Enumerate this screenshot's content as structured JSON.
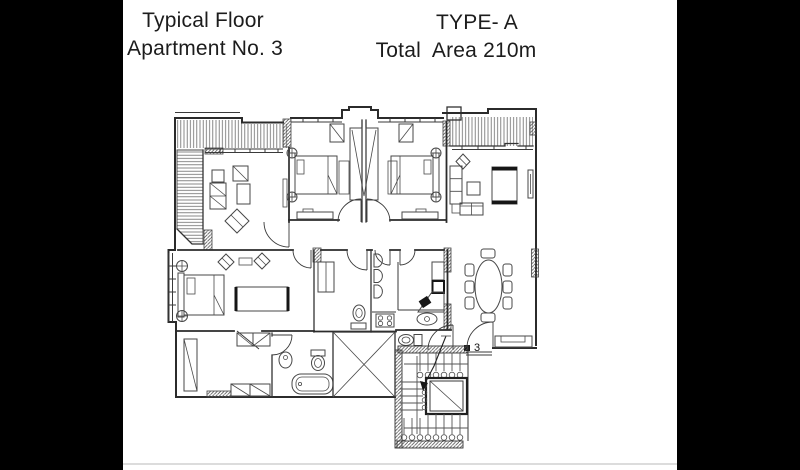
{
  "header": {
    "left_line1": "Typical Floor",
    "left_line2": "Apartment No. 3",
    "right_line1": "TYPE- A",
    "right_line2": "Total  Area 210m"
  },
  "plan": {
    "entrance_label": "3",
    "drawing_description": "Apartment floor plan: two balconies, sitting room, two bedrooms with central wardrobe, living room, master bedroom, dressing room, two bathrooms, WC, kitchen, dining table for eight, stair and elevator core"
  },
  "colors": {
    "ink": "#2b2b2b",
    "furniture_ink": "#474747",
    "hatch": "#666666",
    "background": "#ffffff",
    "letterbox": "#000000",
    "divider_rule": "#dcdcdc"
  }
}
